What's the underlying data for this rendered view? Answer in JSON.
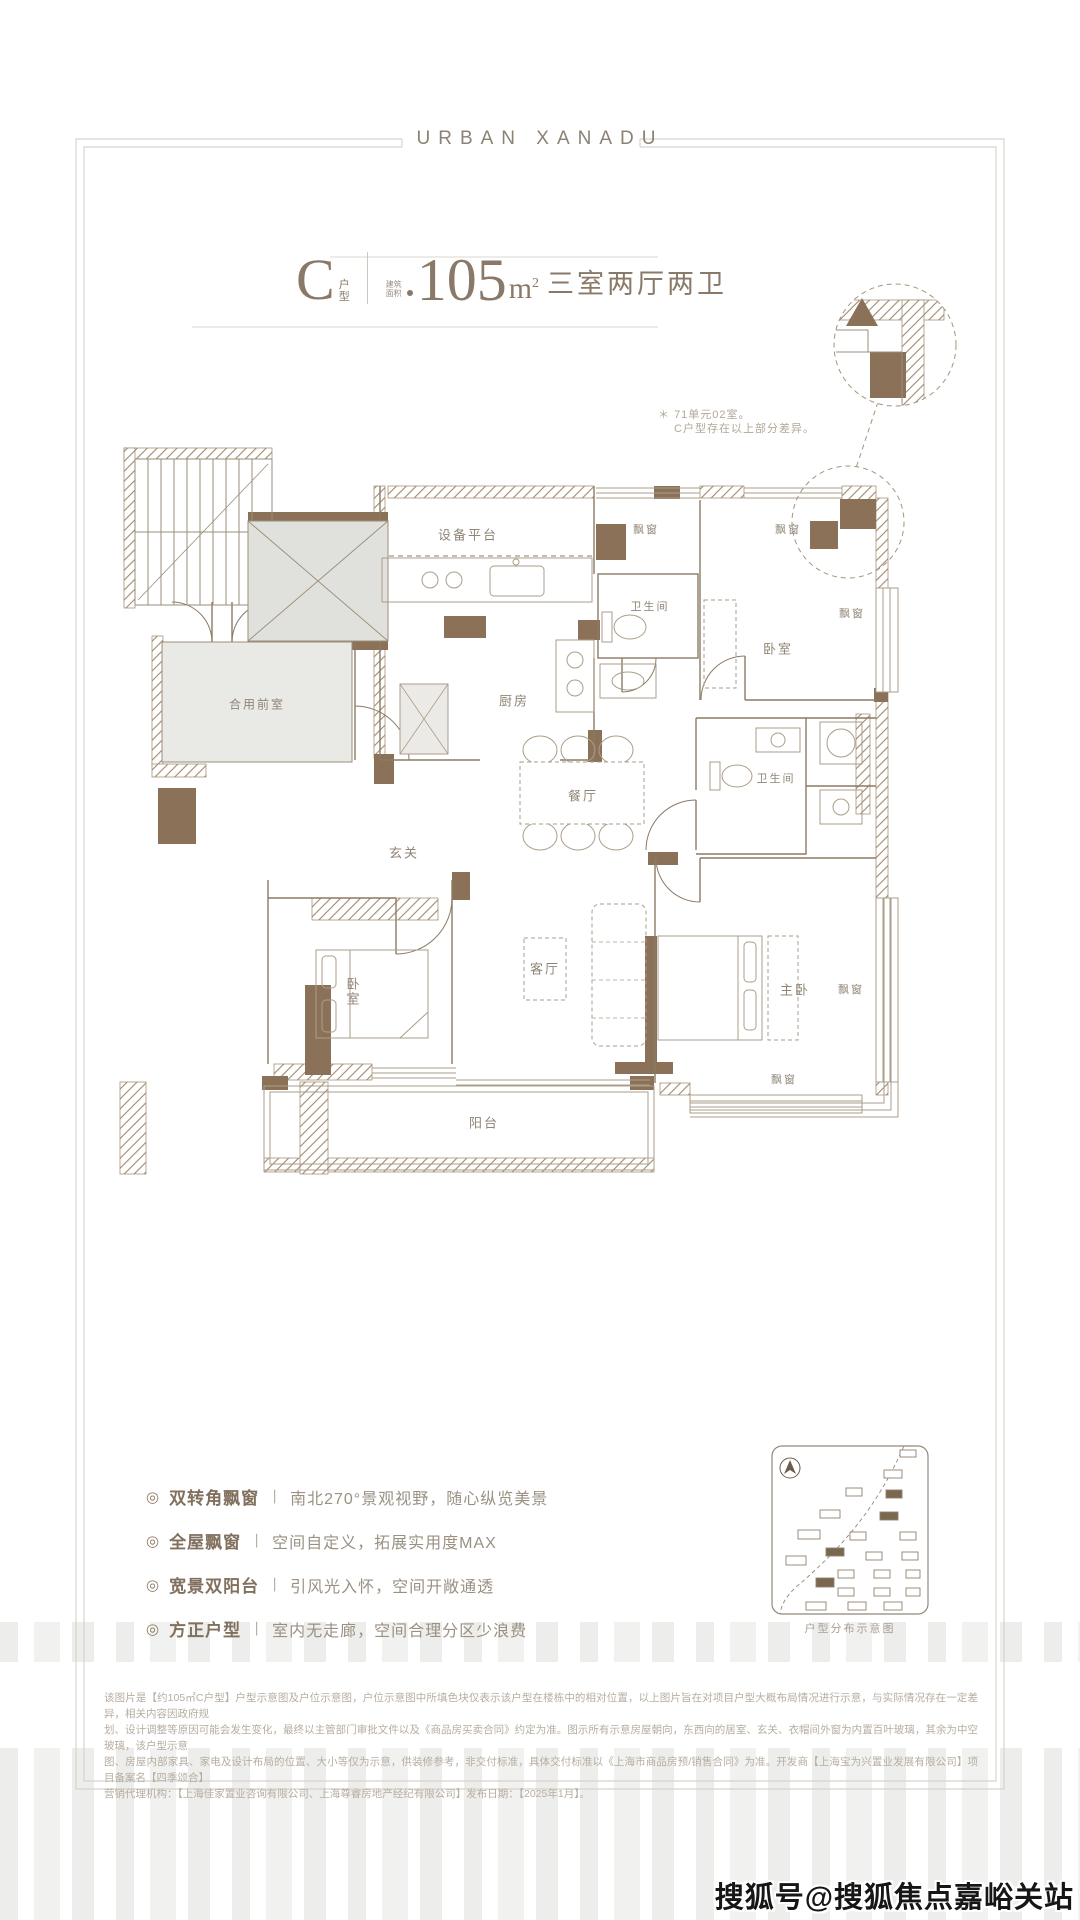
{
  "header": {
    "brand": "URBAN XANADU"
  },
  "title": {
    "type_letter": "C",
    "type_label": "户型",
    "area_note": "建筑面积",
    "area_value": "105",
    "area_unit_letter": "m",
    "area_unit_sup": "2",
    "layout": "三室两厅两卫"
  },
  "callout": {
    "marker": "＊",
    "line1": "71单元02室。",
    "line2": "C户型存在以上部分差异。"
  },
  "floor_plan": {
    "labels": [
      {
        "text": "设备平台",
        "x": 468,
        "y": 534,
        "size": 13
      },
      {
        "text": "飘窗",
        "x": 646,
        "y": 529,
        "size": 11
      },
      {
        "text": "飘窗",
        "x": 788,
        "y": 529,
        "size": 11
      },
      {
        "text": "卫生间",
        "x": 650,
        "y": 606,
        "size": 11
      },
      {
        "text": "卧室",
        "x": 778,
        "y": 648,
        "size": 13
      },
      {
        "text": "飘窗",
        "x": 852,
        "y": 613,
        "size": 11
      },
      {
        "text": "厨房",
        "x": 514,
        "y": 700,
        "size": 13
      },
      {
        "text": "合用前室",
        "x": 257,
        "y": 704,
        "size": 12
      },
      {
        "text": "餐厅",
        "x": 583,
        "y": 795,
        "size": 13
      },
      {
        "text": "卫生间",
        "x": 776,
        "y": 778,
        "size": 11
      },
      {
        "text": "玄关",
        "x": 404,
        "y": 852,
        "size": 13
      },
      {
        "text": "客厅",
        "x": 545,
        "y": 968,
        "size": 13
      },
      {
        "text": "卧室",
        "x": 352,
        "y": 992,
        "size": 13,
        "vertical": true
      },
      {
        "text": "主卧",
        "x": 795,
        "y": 989,
        "size": 13
      },
      {
        "text": "飘窗",
        "x": 851,
        "y": 989,
        "size": 11
      },
      {
        "text": "飘窗",
        "x": 784,
        "y": 1079,
        "size": 11
      },
      {
        "text": "阳台",
        "x": 484,
        "y": 1122,
        "size": 13
      }
    ]
  },
  "features": [
    {
      "icon": "◎",
      "name": "双转角飘窗",
      "divider": "丨",
      "desc": "南北270°景观视野，随心纵览美景"
    },
    {
      "icon": "◎",
      "name": "全屋飘窗",
      "divider": "丨",
      "desc": "空间自定义，拓展实用度MAX"
    },
    {
      "icon": "◎",
      "name": "宽景双阳台",
      "divider": "丨",
      "desc": "引风光入怀，空间开敞通透"
    },
    {
      "icon": "◎",
      "name": "方正户型",
      "divider": "丨",
      "desc": "室内无走廊，空间合理分区少浪费"
    }
  ],
  "site_inset": {
    "caption": "户型分布示意图"
  },
  "disclaimer": {
    "lines": [
      "该图片是【约105㎡C户型】户型示意图及户位示意图，户位示意图中所填色块仅表示该户型在楼栋中的相对位置，以上图片旨在对项目户型大概布局情况进行示意，与实际情况存在一定差异，相关内容因政府规",
      "划、设计调整等原因可能会发生变化，最终以主管部门审批文件以及《商品房买卖合同》约定为准。图示所有示意房屋朝向，东西向的居室、玄关、衣帽间外窗为内置百叶玻璃，其余为中空玻璃，该户型示意",
      "图、房屋内部家具、家电及设计布局的位置、大小等仅为示意，供装修参考，非交付标准，具体交付标准以《上海市商品房预/销售合同》为准。开发商【上海宝为兴置业发展有限公司】项目备案名【四季颂合】",
      "营销代理机构：【上海佳家置业咨询有限公司、上海尊睿房地产经纪有限公司】发布日期：【2025年1月】。"
    ]
  },
  "watermark": "搜狐号@搜狐焦点嘉峪关站",
  "colors": {
    "wall": "#8a7158",
    "wall_line": "#8b7a64",
    "thin_line": "#ab9e89",
    "accent": "#8a7968",
    "light_text": "#b6ada0"
  }
}
